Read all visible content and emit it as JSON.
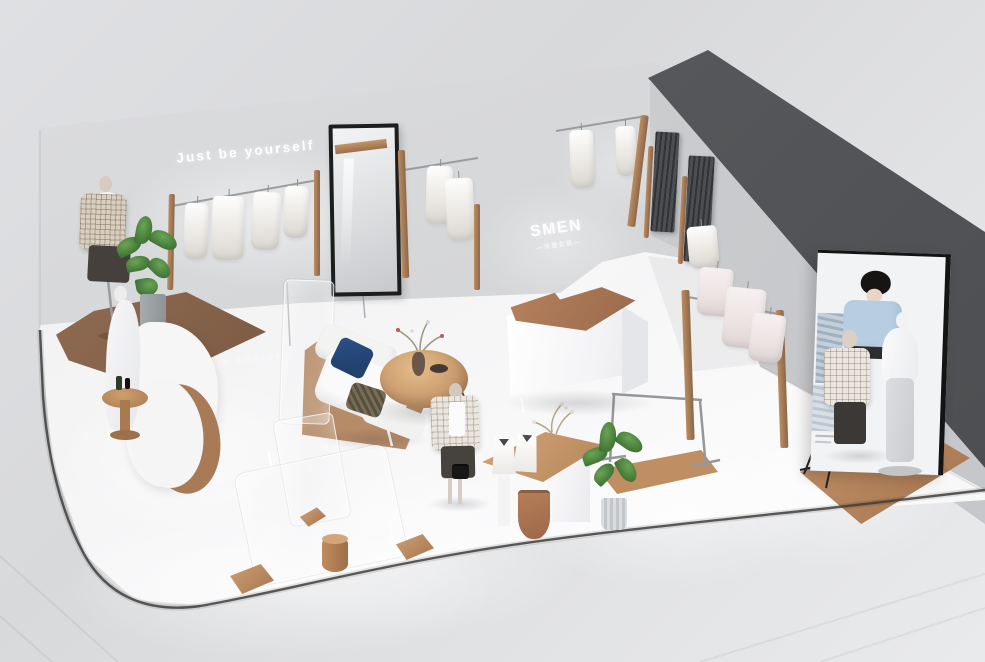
{
  "scene": {
    "type": "3D isometric render",
    "description": "Isometric 3D visualization of a minimalist women's clothing store interior",
    "wall_slogan": "Just be yourself",
    "floor_reflection_text": "Just be yourself",
    "brand": {
      "logo": "SMEN",
      "tagline": "—诗曼女装—"
    },
    "objects": [
      "mannequin in plaid jacket",
      "potted plants",
      "wall clothing racks with hanging garments",
      "leaning floor mirror",
      "fitting rooms with dark curtains",
      "white cashier counter with wood top",
      "white sofa with navy pillow",
      "round wooden coffee table",
      "acrylic glass partitions",
      "display table with white shopping bags",
      "empty metal clothing rail",
      "poster lightbox with model photo",
      "white abstract mannequin",
      "wooden platforms and stools",
      "curved white display stand"
    ]
  },
  "colors": {
    "background": "#dcdde0",
    "wall": "#d5d6d8",
    "dark-wall": "#55575a",
    "floor": "#f4f4f5",
    "outside-floor": "#e7e8ea",
    "wood": "#a97a56",
    "wood-dark": "#8d6950",
    "trim": "#3e3d3c",
    "curtain": "#45474b",
    "navy-pillow": "#21416f",
    "plant": "#4e8040",
    "poster-blue": "#b6cde2",
    "mirror-frame": "#1d1d1d",
    "text-white": "#ffffff"
  }
}
